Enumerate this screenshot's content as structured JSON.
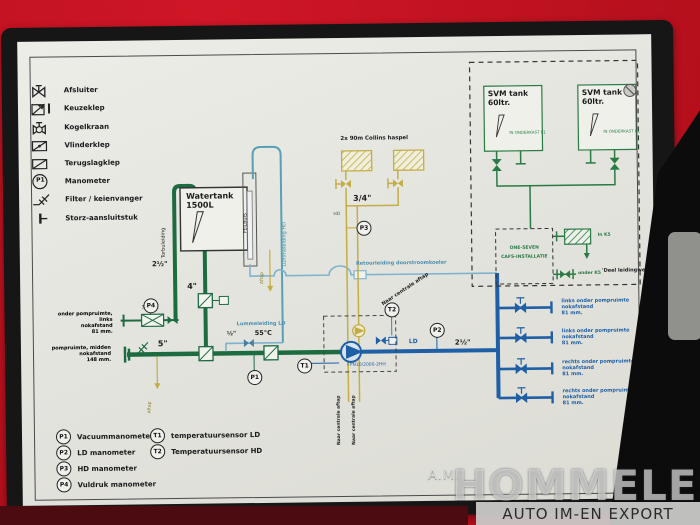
{
  "legend": {
    "items": [
      {
        "label": "Afsluiter",
        "icon": "shutoff-valve-icon"
      },
      {
        "label": "Keuzeklep",
        "icon": "selector-valve-icon"
      },
      {
        "label": "Kogelkraan",
        "icon": "ball-valve-icon"
      },
      {
        "label": "Vlinderklep",
        "icon": "butterfly-valve-icon"
      },
      {
        "label": "Terugslagklep",
        "icon": "check-valve-icon"
      },
      {
        "label": "Manometer",
        "icon": "gauge-icon",
        "badge": "P1"
      },
      {
        "label": "Filter / keienvanger",
        "icon": "filter-icon"
      },
      {
        "label": "Storz-aansluitstuk",
        "icon": "storz-icon"
      }
    ]
  },
  "tank": {
    "title": "Watertank",
    "capacity": "1500L",
    "peilbuis": "PEILBUIS",
    "torbuleiding": "Torbuleiding",
    "size_fill": "2½\"",
    "size_suction": "4\"",
    "aftap": "Aftap",
    "lummeleiding_hd": "Lummeleiding HD"
  },
  "hd": {
    "reels": "2x 90m Collins haspel",
    "size": "3/4\"",
    "hd": "HD",
    "p3": "P3"
  },
  "fill_line": {
    "l1": "onder pompruimte, links",
    "l2": "nokafstand",
    "l3": "81 mm.",
    "filter": "32 mm.",
    "p4": "P4"
  },
  "suction_line": {
    "l1": "pompruimte, midden",
    "l2": "nokafstand",
    "l3": "148 mm.",
    "size": "5\""
  },
  "center": {
    "retour": "Retourleiding doorstroomkoeler",
    "naar": "Naar centrale aftap",
    "lummeleiding_ld": "Lummeleiding LD",
    "half": "½\"",
    "temp": "55°C",
    "t1": "T1",
    "t2": "T2",
    "p1": "P1",
    "p2": "P2",
    "pump_model": "FPN10/2000-2HH",
    "ld": "LD",
    "size": "2½\"",
    "aftap": "Aftap"
  },
  "svm": {
    "tank1": {
      "title": "SVM tank",
      "capacity": "60ltr.",
      "note": "IN ONDERKAST K1"
    },
    "tank2": {
      "title": "SVM tank",
      "capacity": "60ltr.",
      "note": "IN ONDERKAST K1"
    },
    "unit1": "ONE-SEVEN",
    "unit2": "CAFS-INSTALLATIE",
    "in_k5": "In K5",
    "onder_k5": "onder K5",
    "deel": "'Deel leidingwerk'"
  },
  "outlets": [
    {
      "l1": "links onder pompruimte",
      "l2": "nokafstand",
      "l3": "81 mm."
    },
    {
      "l1": "links onder pompruimte",
      "l2": "nokafstand",
      "l3": "81 mm."
    },
    {
      "l1": "rechts onder pompruimte",
      "l2": "nokafstand",
      "l3": "81 mm."
    },
    {
      "l1": "rechts onder pompruimte",
      "l2": "nokafstand",
      "l3": "81 mm."
    }
  ],
  "gauges": {
    "p_rows": [
      {
        "id": "P1",
        "label": "Vacuummanometer"
      },
      {
        "id": "P2",
        "label": "LD manometer"
      },
      {
        "id": "P3",
        "label": "HD manometer"
      },
      {
        "id": "P4",
        "label": "Vuldruk manometer"
      }
    ],
    "t_rows": [
      {
        "id": "T1",
        "label": "temperatuursensor LD"
      },
      {
        "id": "T2",
        "label": "Temperatuursensor HD"
      }
    ]
  },
  "watermark": {
    "prefix": "A.M.",
    "name": "HOMMELES",
    "tagline": "AUTO IM-EN EXPORT"
  },
  "colors": {
    "truck_red": "#b40f1c",
    "frame_black": "#161616",
    "paper": "#e8e8e2",
    "pipe_green": "#1d6b40",
    "pipe_yellow": "#c4ad45",
    "pipe_blue": "#1e5fa6",
    "pipe_lightblue": "#7fb3cd",
    "pipe_teal": "#57a0b5"
  }
}
